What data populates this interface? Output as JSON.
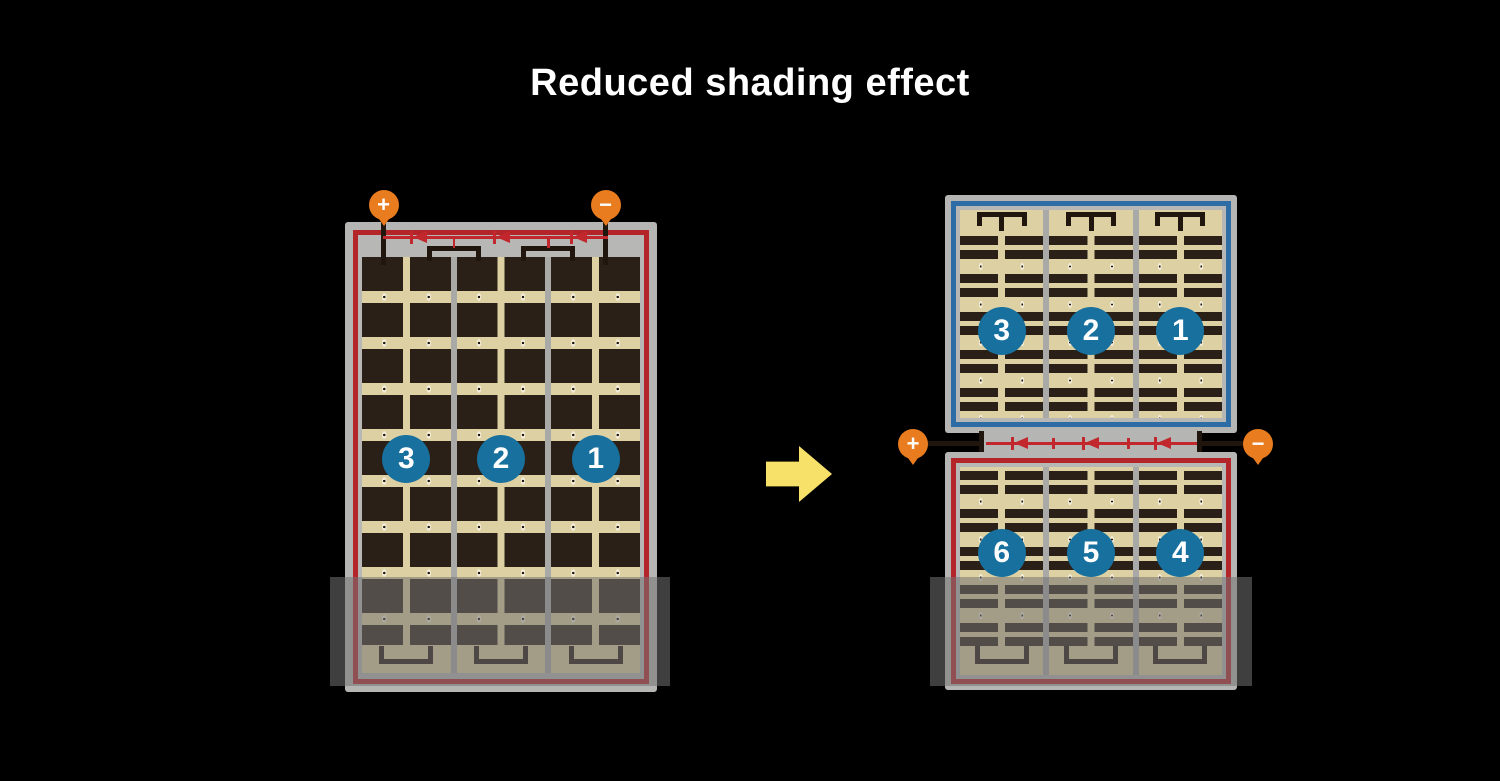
{
  "title": "Reduced shading effect",
  "colors": {
    "background": "#000000",
    "panel_frame": "#b5b5b4",
    "cell_dark": "#2a2017",
    "cell_bg_tan": "#ddd1a3",
    "busbar_black": "#20160e",
    "series_red": "#b4252a",
    "wire_red": "#c1272d",
    "series_blue": "#2e6ca6",
    "group_badge_blue": "#17709e",
    "terminal_orange": "#e87c1e",
    "arrow_yellow": "#f8e169",
    "divider_gray": "#a9a9a8",
    "shade_overlay": "rgba(115,115,115,0.55)"
  },
  "left_panel": {
    "terminals": {
      "positive": "+",
      "negative": "−"
    },
    "groups": [
      "3",
      "2",
      "1"
    ]
  },
  "arrow": {
    "direction": "right"
  },
  "right_panel": {
    "terminals": {
      "positive": "+",
      "negative": "−"
    },
    "top_groups": [
      "3",
      "2",
      "1"
    ],
    "bottom_groups": [
      "6",
      "5",
      "4"
    ]
  }
}
